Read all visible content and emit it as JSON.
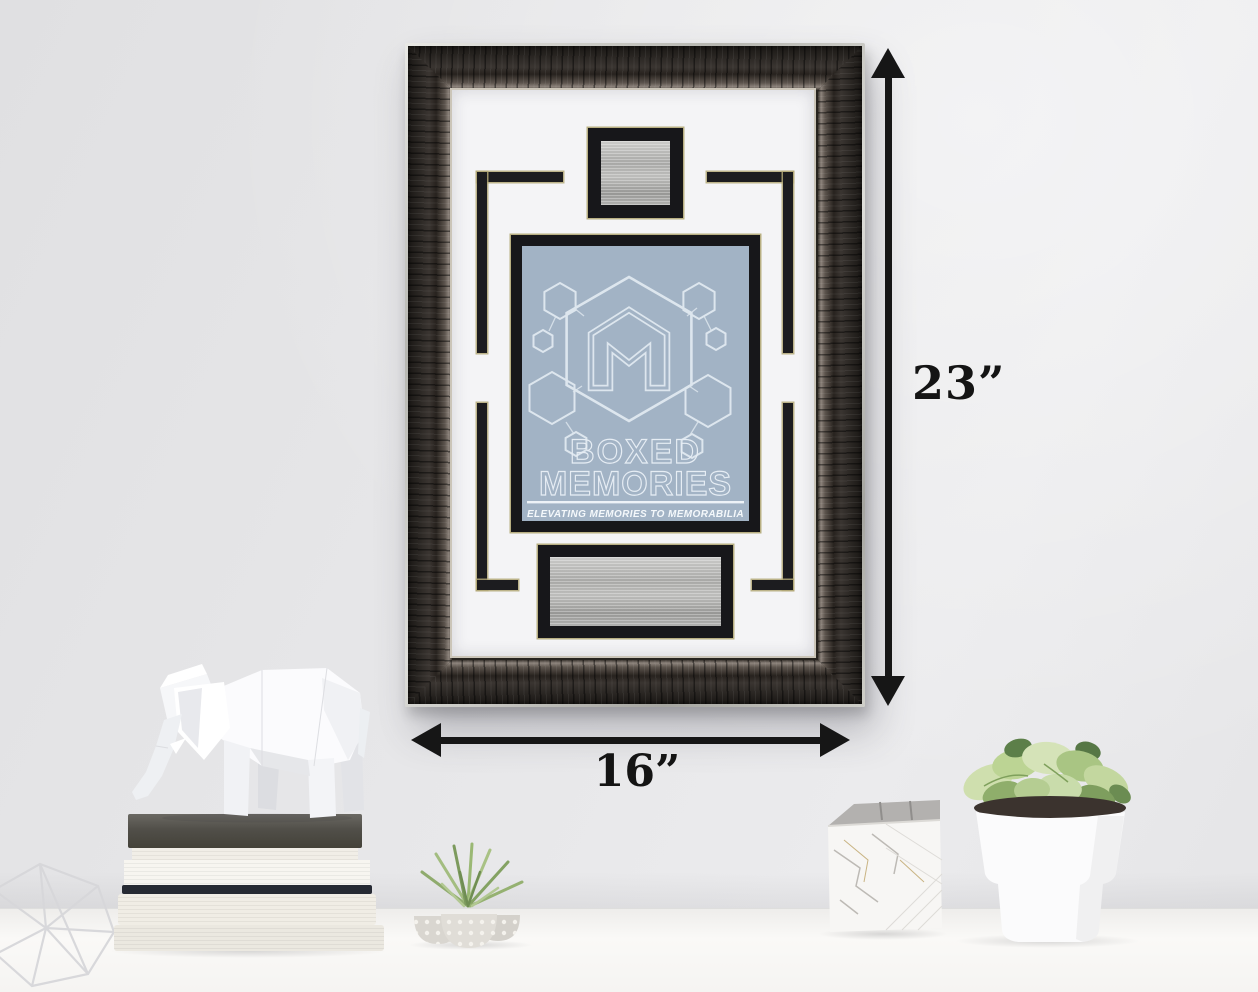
{
  "scene": {
    "description": "Black pewter Boxed Memories display frame with white mat, engraving plates and logo print, hung on a wall above a white desk with decor objects"
  },
  "dimensions": {
    "height_label": "23”",
    "width_label": "16”"
  },
  "print": {
    "monogram": "M",
    "title_line1": "BOXED",
    "title_line2": "MEMORIES",
    "tagline": "ELEVATING MEMORIES TO MEMORABILIA"
  },
  "colors": {
    "wall": "#e6e6e8",
    "desk": "#f8f7f5",
    "frame_wood": "#2b2826",
    "frame_silver_edge": "#cfcfc9",
    "mat": "#f4f4f6",
    "accent_black": "#1c1c1f",
    "accent_gold": "#b1a776",
    "plate_silver": "#b3b3b1",
    "print_background": "#a2b3c5",
    "print_line": "#e3ebf2",
    "arrow": "#161616"
  },
  "decor": {
    "left": [
      "wire geometric ornament",
      "stack of books",
      "geometric elephant figurine"
    ],
    "center": [
      "air plant in polka-dot pots"
    ],
    "right": [
      "marble pencil cup",
      "white potted plant"
    ]
  }
}
